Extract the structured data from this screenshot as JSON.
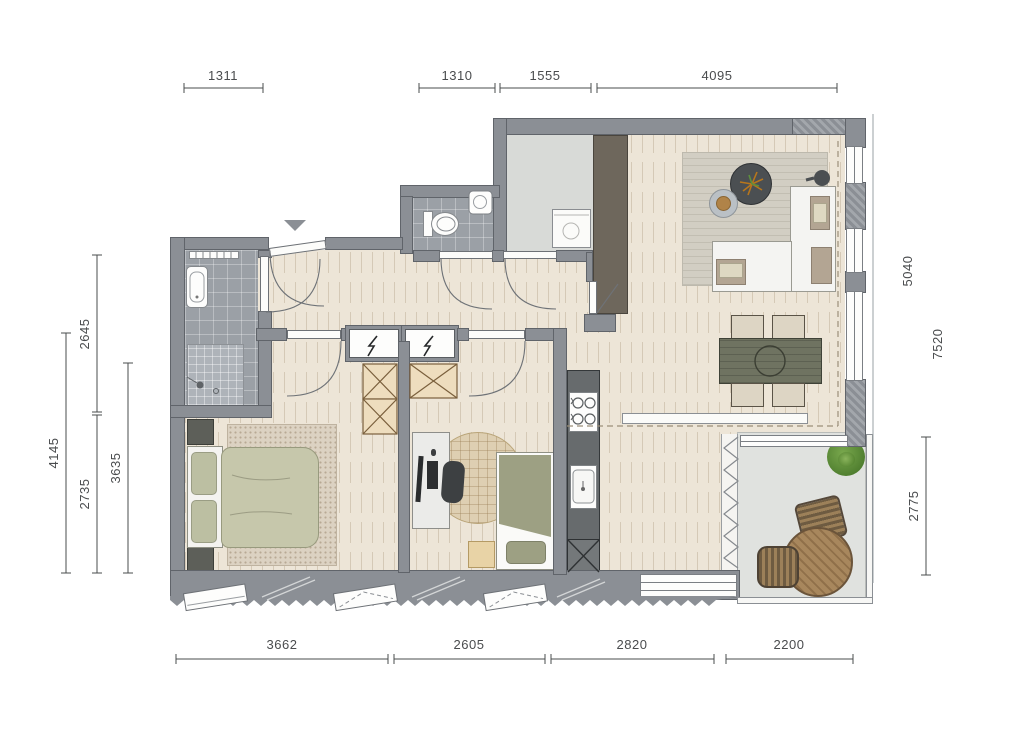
{
  "dims": {
    "top": [
      {
        "label": "1311"
      },
      {
        "label": "1310"
      },
      {
        "label": "1555"
      },
      {
        "label": "4095"
      }
    ],
    "left": [
      {
        "label": "2645"
      },
      {
        "label": "4145"
      },
      {
        "label": "2735"
      },
      {
        "label": "3635"
      }
    ],
    "right": [
      {
        "label": "5040"
      },
      {
        "label": "7520"
      },
      {
        "label": "2775"
      }
    ],
    "bottom": [
      {
        "label": "3662"
      },
      {
        "label": "2605"
      },
      {
        "label": "2820"
      },
      {
        "label": "2200"
      }
    ]
  },
  "icons": {
    "electrical_shaft": "lightning-bolt",
    "entrance_marker": "triangle-down",
    "closet": "crossed-box"
  },
  "colors": {
    "wall": "#8b8f95",
    "floor_wood": "#ede5d7",
    "floor_tile": "#9ba0a6",
    "floor_storage": "#d8dad7",
    "floor_balcony": "#e0e2df",
    "tv_cabinet": "#6e675c",
    "kitchen_counter": "#676b6d",
    "dining_table": "#6f7361",
    "sofa": "#f4f4f2",
    "cushion": "#b3a593",
    "duvet_sage": "#c6c7ab",
    "duvet_olive": "#9da083",
    "closet_fill": "#eeddbe",
    "plant": "#5d8f3d",
    "balcony_table": "#a8875d",
    "dimension_text": "#4a4c4e"
  }
}
